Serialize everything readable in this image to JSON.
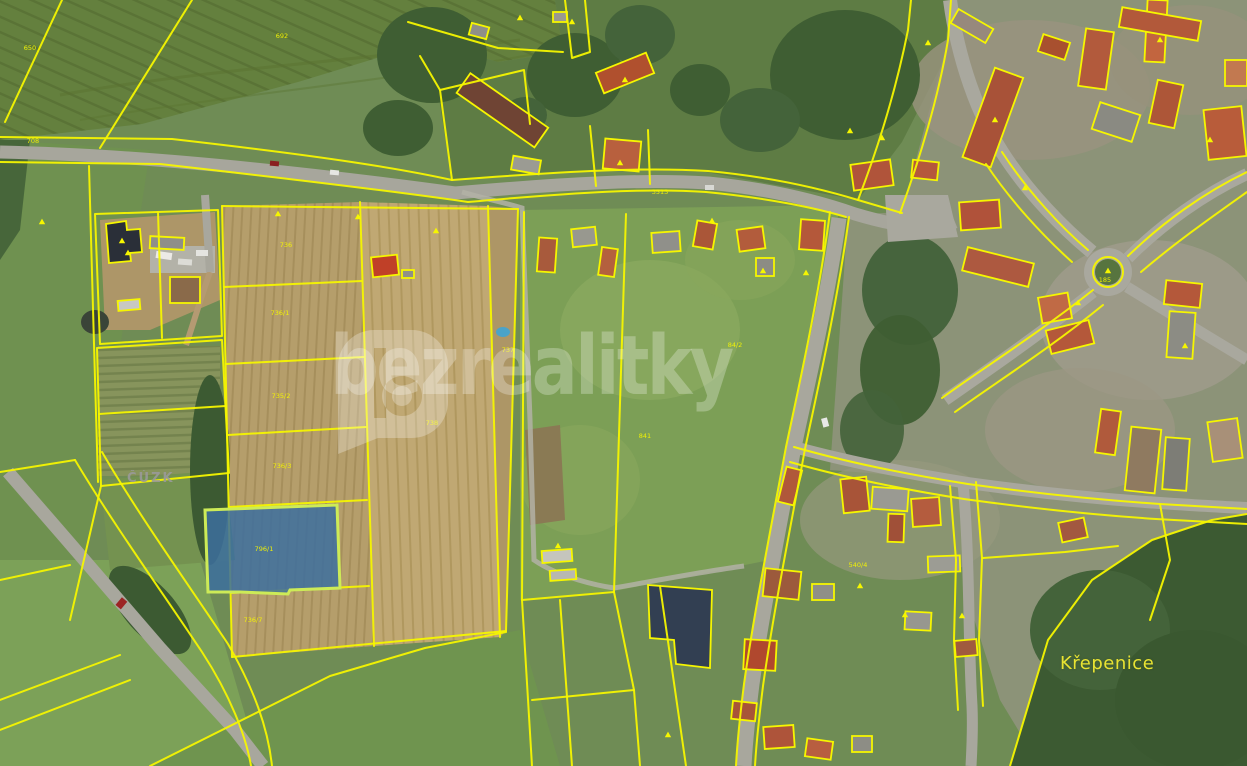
{
  "map": {
    "attribution": "ČÚZK",
    "place": "Křepenice",
    "watermark_text": "bezrealitky",
    "colors": {
      "cadastral_line": "#f6f600",
      "highlight_fill": "#3c6f9f",
      "highlight_stroke": "#cdeb57",
      "place_label": "#e8e332",
      "attribution_label": "#9a9a9a",
      "watermark": "rgba(255,255,255,0.27)"
    },
    "highlight_parcel": {
      "label": "796/1"
    },
    "parcel_labels": [
      {
        "t": "650",
        "x": 30,
        "y": 50
      },
      {
        "t": "708",
        "x": 33,
        "y": 143
      },
      {
        "t": "692",
        "x": 282,
        "y": 38
      },
      {
        "t": "3513",
        "x": 660,
        "y": 194
      },
      {
        "t": "736",
        "x": 286,
        "y": 247
      },
      {
        "t": "736/1",
        "x": 280,
        "y": 315
      },
      {
        "t": "735/2",
        "x": 281,
        "y": 398
      },
      {
        "t": "736/3",
        "x": 282,
        "y": 468
      },
      {
        "t": "796/1",
        "x": 264,
        "y": 551
      },
      {
        "t": "736/7",
        "x": 253,
        "y": 622
      },
      {
        "t": "738",
        "x": 432,
        "y": 425
      },
      {
        "t": "737",
        "x": 508,
        "y": 352
      },
      {
        "t": "84/2",
        "x": 735,
        "y": 347
      },
      {
        "t": "841",
        "x": 645,
        "y": 438
      },
      {
        "t": "185",
        "x": 1105,
        "y": 282
      },
      {
        "t": "540/4",
        "x": 858,
        "y": 567
      }
    ],
    "building_symbols": [
      [
        42,
        222
      ],
      [
        128,
        253
      ],
      [
        278,
        214
      ],
      [
        358,
        217
      ],
      [
        436,
        231
      ],
      [
        520,
        18
      ],
      [
        572,
        22
      ],
      [
        620,
        163
      ],
      [
        712,
        221
      ],
      [
        763,
        271
      ],
      [
        806,
        273
      ],
      [
        850,
        131
      ],
      [
        882,
        138
      ],
      [
        928,
        43
      ],
      [
        995,
        120
      ],
      [
        1025,
        188
      ],
      [
        1078,
        303
      ],
      [
        1108,
        271
      ],
      [
        1160,
        40
      ],
      [
        1185,
        346
      ],
      [
        1210,
        140
      ],
      [
        860,
        586
      ],
      [
        905,
        615
      ],
      [
        962,
        616
      ],
      [
        668,
        735
      ],
      [
        558,
        546
      ],
      [
        122,
        241
      ],
      [
        625,
        80
      ]
    ]
  }
}
